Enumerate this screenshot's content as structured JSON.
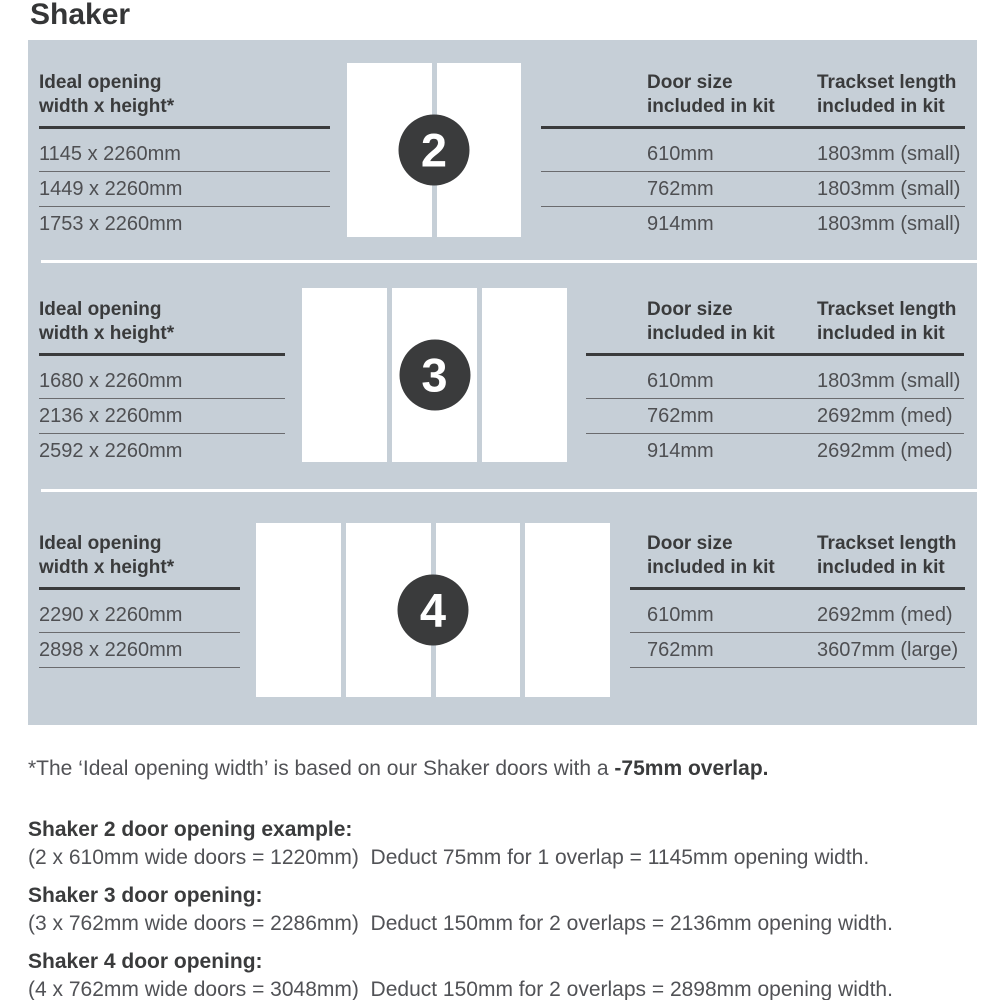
{
  "title": "Shaker",
  "panel": {
    "opening_col": {
      "line1": "Ideal opening",
      "line2": "width x height*"
    },
    "door_col": {
      "line1": "Door size",
      "line2": "included in kit"
    },
    "track_col": {
      "line1": "Trackset length",
      "line2": "included in kit"
    },
    "sections": [
      {
        "door_count": "2",
        "openings": [
          "1145 x 2260mm",
          "1449 x 2260mm",
          "1753 x 2260mm"
        ],
        "rows": [
          {
            "door_size": "610mm",
            "trackset": "1803mm (small)"
          },
          {
            "door_size": "762mm",
            "trackset": "1803mm (small)"
          },
          {
            "door_size": "914mm",
            "trackset": "1803mm (small)"
          }
        ]
      },
      {
        "door_count": "3",
        "openings": [
          "1680 x 2260mm",
          "2136 x 2260mm",
          "2592 x 2260mm"
        ],
        "rows": [
          {
            "door_size": "610mm",
            "trackset": "1803mm (small)"
          },
          {
            "door_size": "762mm",
            "trackset": "2692mm (med)"
          },
          {
            "door_size": "914mm",
            "trackset": "2692mm (med)"
          }
        ]
      },
      {
        "door_count": "4",
        "openings": [
          "2290 x 2260mm",
          "2898 x 2260mm"
        ],
        "rows": [
          {
            "door_size": "610mm",
            "trackset": "2692mm (med)"
          },
          {
            "door_size": "762mm",
            "trackset": "3607mm (large)"
          }
        ]
      }
    ]
  },
  "footnote": {
    "text": "*The ‘Ideal opening width’ is based on our Shaker doors with a ",
    "bold": "-75mm overlap."
  },
  "examples": [
    {
      "heading": "Shaker 2 door opening example:",
      "body": "(2 x 610mm wide doors = 1220mm)  Deduct 75mm for 1 overlap = 1145mm opening width."
    },
    {
      "heading": "Shaker 3 door opening:",
      "body": "(3 x 762mm wide doors = 2286mm)  Deduct 150mm for 2 overlaps = 2136mm opening width."
    },
    {
      "heading": "Shaker 4 door opening:",
      "body": "(4 x 762mm wide doors = 3048mm)  Deduct 150mm for 2 overlaps = 2898mm opening width."
    }
  ],
  "colors": {
    "panel_bg": "#c6cfd7",
    "badge": "#3a3b3c",
    "heading_text": "#3a3b3c",
    "body_text": "#515256",
    "door_panel": "#ffffff"
  }
}
